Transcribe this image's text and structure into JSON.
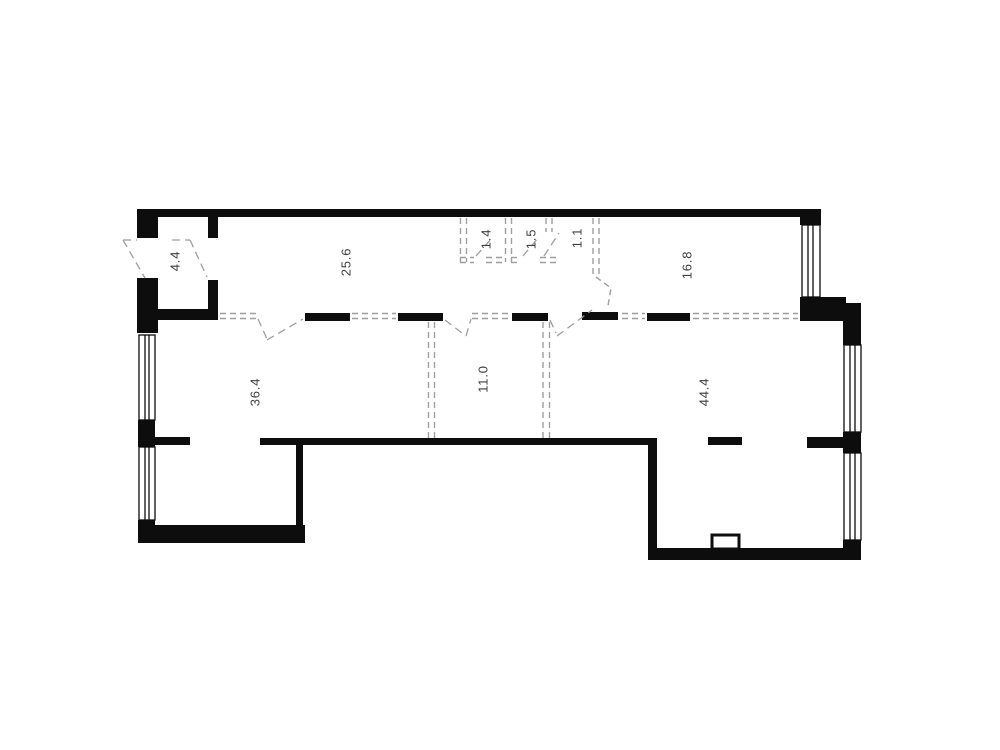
{
  "floor_plan": {
    "colors": {
      "background": "#ffffff",
      "wall": "#0d0d0d",
      "label": "#3f3f3f",
      "dashed": "#9e9e9e"
    },
    "rooms": [
      {
        "id": "entry-hall",
        "label": "4.4"
      },
      {
        "id": "room-a",
        "label": "25.6"
      },
      {
        "id": "closet-1",
        "label": "1.4"
      },
      {
        "id": "closet-2",
        "label": "1.5"
      },
      {
        "id": "closet-3",
        "label": "1.1"
      },
      {
        "id": "room-b",
        "label": "16.8"
      },
      {
        "id": "room-c",
        "label": "36.4"
      },
      {
        "id": "room-d",
        "label": "11.0"
      },
      {
        "id": "room-e",
        "label": "44.4"
      }
    ]
  }
}
